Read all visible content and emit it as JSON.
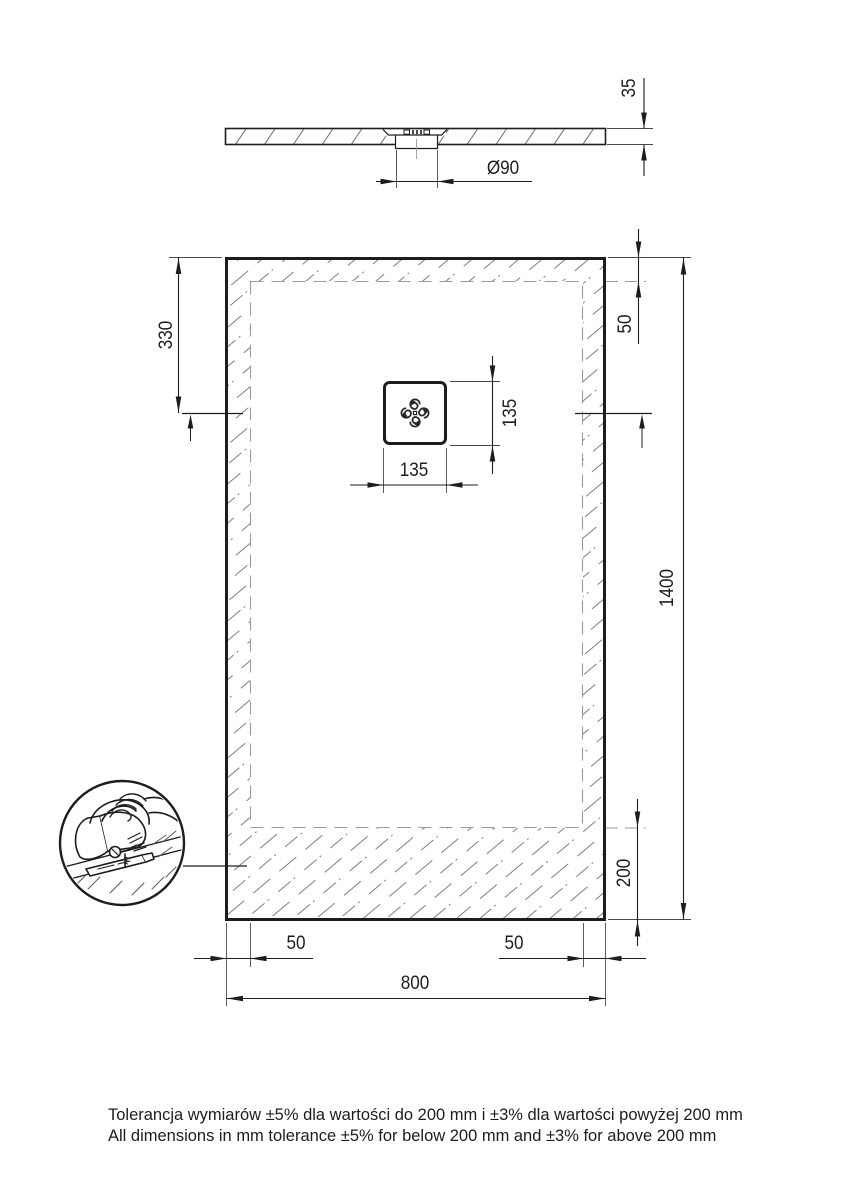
{
  "title": "Shower tray dimensional drawing",
  "labels": {
    "profile_thickness": "35",
    "drain_diameter": "Ø90",
    "drain_offset_top": "330",
    "margin_top": "50",
    "drain_width": "135",
    "drain_height": "135",
    "length": "1400",
    "trim_zone": "200",
    "margin_left": "50",
    "margin_right": "50",
    "width": "800"
  },
  "notes": {
    "line_pl": "Tolerancja wymiarów ±5% dla wartości do 200 mm i ±3% dla wartości powyżej 200 mm",
    "line_en": "All dimensions in mm tolerance ±5% for below 200 mm and ±3% for above 200 mm"
  },
  "colors": {
    "line": "#1d1d1b",
    "hatch": "#7f7f7f",
    "dashed_boundary": "#9b9b9b",
    "background": "#ffffff"
  }
}
